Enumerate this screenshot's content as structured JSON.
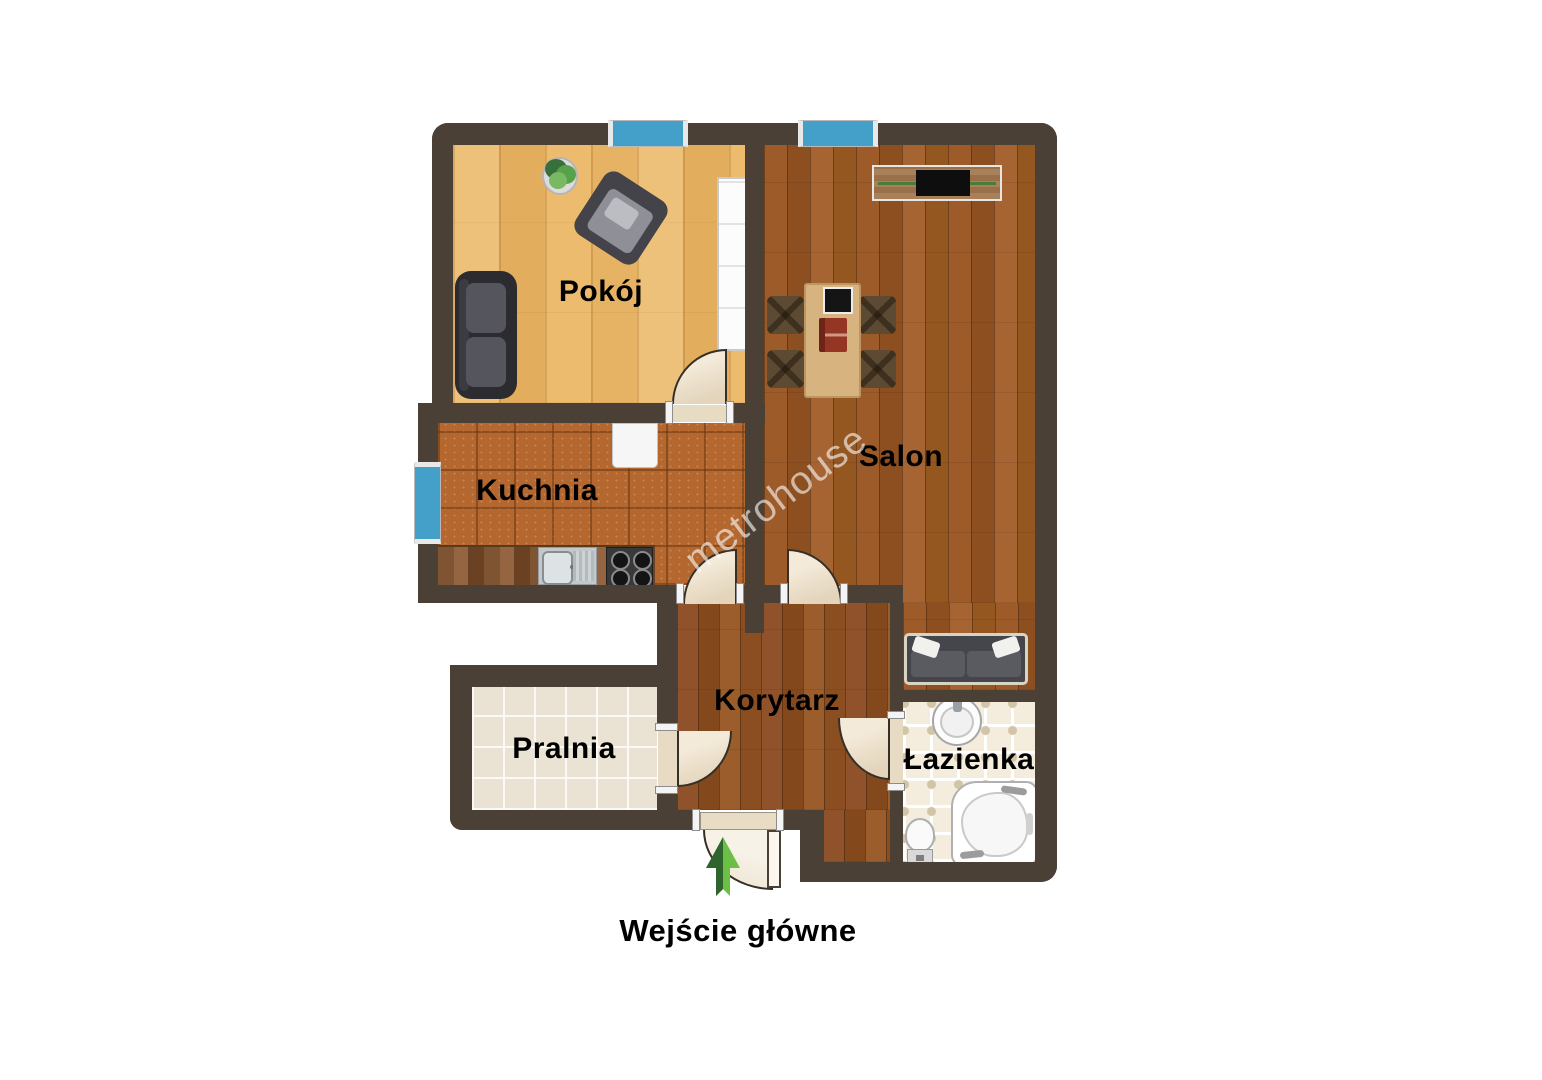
{
  "watermark": {
    "text": "metrohouse"
  },
  "rooms": {
    "pokoj": {
      "label": "Pokój"
    },
    "kuchnia": {
      "label": "Kuchnia"
    },
    "salon": {
      "label": "Salon"
    },
    "korytarz": {
      "label": "Korytarz"
    },
    "pralnia": {
      "label": "Pralnia"
    },
    "lazienka": {
      "label": "Łazienka"
    }
  },
  "entrance": {
    "label": "Wejście główne"
  },
  "icons": {
    "entrance-arrow-icon": "two-tone green up-arrow marking main entrance",
    "window-icon": "blue wall-opening bar",
    "door-arc-icon": "quarter-circle door swing"
  },
  "colors": {
    "wall": "#4b4036",
    "window_blue": "#45a0c9",
    "door_arc": "#f0e4d1",
    "pokoj_floor": "#eabc6f",
    "salon_floor": "#9a5a28",
    "korytarz_floor": "#8f5426",
    "kuchnia_tile": "#b4672f",
    "pralnia_floor": "#eae3d4",
    "lazienka_floor": "#f4edde",
    "arrow_dark_green": "#2f642e",
    "arrow_light_green": "#6cbf45"
  },
  "furniture": [
    "sofa",
    "armchair",
    "plant",
    "wardrobe",
    "tv-cabinet",
    "dining-table",
    "dining-chair",
    "picture-frame",
    "book",
    "kitchen-counter",
    "kitchen-sink",
    "stove",
    "fridge",
    "salon-sofa",
    "washbasin",
    "toilet",
    "corner-bathtub"
  ]
}
